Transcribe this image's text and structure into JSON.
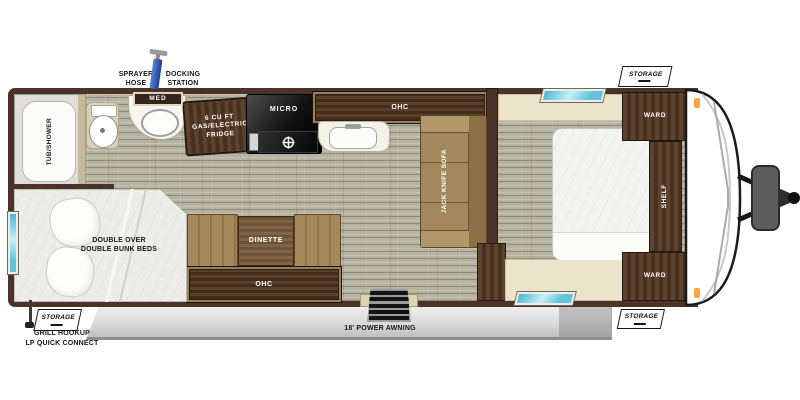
{
  "exterior": {
    "sprayer_hose_label": "SPRAYER\nHOSE",
    "docking_station_label": "DOCKING\nSTATION",
    "storage_flap_top_label": "STORAGE",
    "storage_flap_rear_label": "STORAGE",
    "storage_flap_front_label": "STORAGE",
    "grill_hookup_label": "GRILL HOOKUP\nLP QUICK CONNECT",
    "awning_label": "18' POWER AWNING"
  },
  "bathroom": {
    "tub_shower_label": "TUB/SHOWER",
    "med_cabinet_label": "MED"
  },
  "kitchen": {
    "fridge_label": "6 CU FT\nGAS/ELECTRIC\nFRIDGE",
    "micro_label": "MICRO",
    "ohc_label": "OHC"
  },
  "living": {
    "sofa_label": "JACK KNIFE SOFA",
    "dinette_label": "DINETTE",
    "ohc_label": "OHC"
  },
  "bunk_room": {
    "bed_label": "DOUBLE OVER\nDOUBLE BUNK BEDS"
  },
  "bedroom": {
    "ward_top_label": "WARD",
    "ward_bottom_label": "WARD",
    "shelf_label": "SHELF"
  },
  "colors": {
    "wall_brown": "#4b3329",
    "floor_plank": "#b5b2a0",
    "cabinet_wood": "#4a3322",
    "cushion_tan": "#a2885c",
    "cream_surface": "#ece4ca",
    "window_glass": "#63c3dd",
    "awning_gray": "#d9d9d9",
    "marker_orange": "#f2a63c",
    "sprayer_blue": "#2b57a8"
  }
}
